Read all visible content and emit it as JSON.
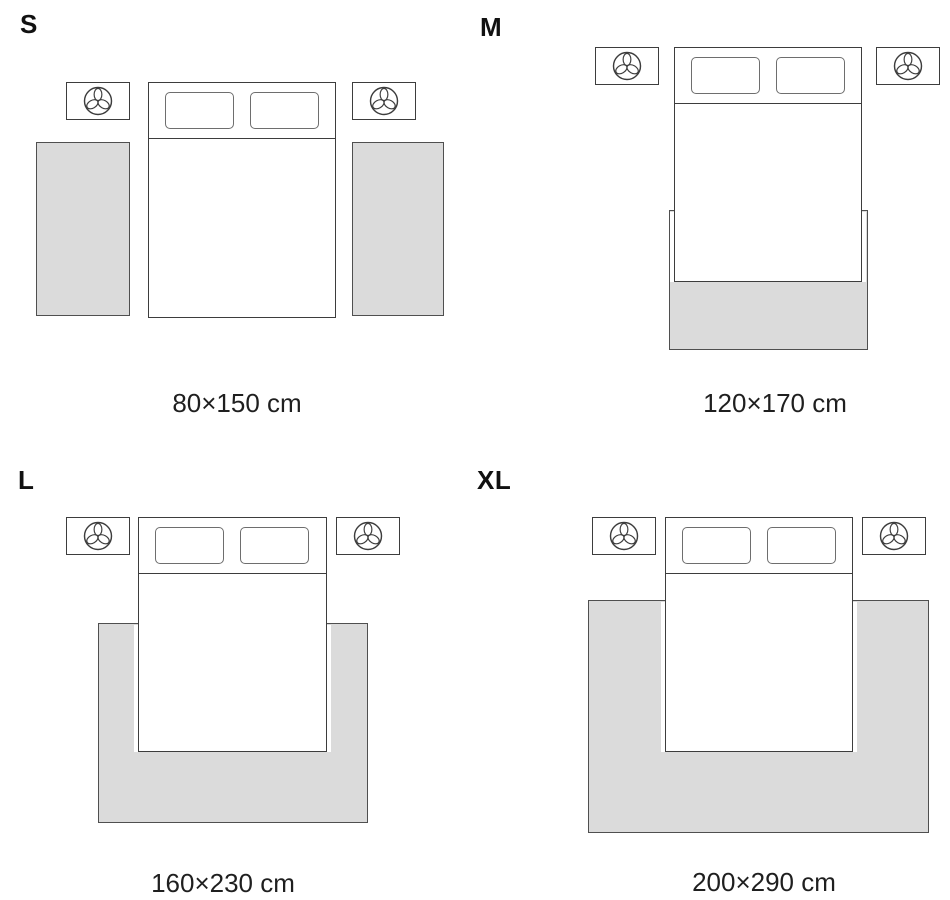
{
  "sizes": [
    {
      "label": "S",
      "dimensions": "80×150 cm"
    },
    {
      "label": "M",
      "dimensions": "120×170 cm"
    },
    {
      "label": "L",
      "dimensions": "160×230 cm"
    },
    {
      "label": "XL",
      "dimensions": "200×290 cm"
    }
  ],
  "icons": {
    "nightstand": "plant-icon"
  },
  "colors": {
    "background": "#ffffff",
    "rug_fill": "#dbdbdb",
    "rug_border": "#4f4f4f",
    "furniture_outline": "#3d3d3d",
    "pillow_outline": "#6e6e6e",
    "label_text": "#111111",
    "caption_text": "#1f1f1f"
  }
}
